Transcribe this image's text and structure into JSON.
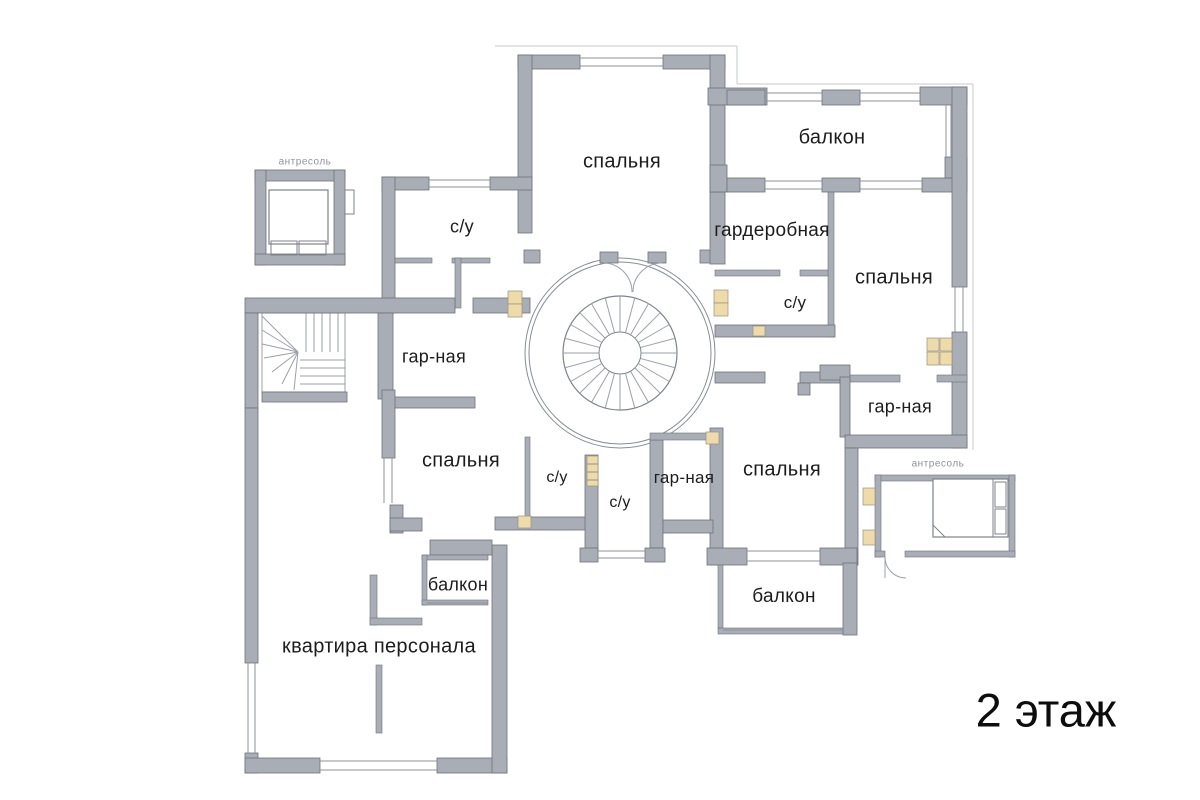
{
  "floor_title": {
    "text": "2 этаж",
    "x": 1046,
    "y": 710,
    "size": 47
  },
  "colors": {
    "background": "#ffffff",
    "wall_fill": "#a9adb5",
    "wall_outline": "#6d727c",
    "thin_line": "#8d929c",
    "shaft_fill": "#eedbaa",
    "label_text": "#1c1c1c",
    "mezzanine_label_text": "#8d939e",
    "title_text": "#0d0d0d"
  },
  "labels": [
    {
      "id": "bedroom-top",
      "text": "спальня",
      "x": 622,
      "y": 162,
      "size": 20
    },
    {
      "id": "balcony-top-right",
      "text": "балкон",
      "x": 832,
      "y": 138,
      "size": 20
    },
    {
      "id": "wardrobe-right",
      "text": "гардеробная",
      "x": 772,
      "y": 231,
      "size": 19
    },
    {
      "id": "bathroom-right",
      "text": "с/у",
      "x": 795,
      "y": 303,
      "size": 17
    },
    {
      "id": "bedroom-right",
      "text": "спальня",
      "x": 894,
      "y": 278,
      "size": 20
    },
    {
      "id": "dressing-right",
      "text": "гар-ная",
      "x": 900,
      "y": 407,
      "size": 18
    },
    {
      "id": "mezzanine-right",
      "text": "антресоль",
      "x": 938,
      "y": 464,
      "size": 10,
      "variant": "mezzanine"
    },
    {
      "id": "bathroom-left-top",
      "text": "с/у",
      "x": 462,
      "y": 227,
      "size": 18
    },
    {
      "id": "dressing-left",
      "text": "гар-ная",
      "x": 434,
      "y": 357,
      "size": 18
    },
    {
      "id": "bedroom-left",
      "text": "спальня",
      "x": 461,
      "y": 461,
      "size": 20
    },
    {
      "id": "bathroom-center-1",
      "text": "с/у",
      "x": 557,
      "y": 478,
      "size": 16
    },
    {
      "id": "bathroom-center-2",
      "text": "с/у",
      "x": 620,
      "y": 503,
      "size": 16
    },
    {
      "id": "dressing-center",
      "text": "гар-ная",
      "x": 684,
      "y": 478,
      "size": 17
    },
    {
      "id": "bedroom-bottom-right",
      "text": "спальня",
      "x": 782,
      "y": 470,
      "size": 20
    },
    {
      "id": "balcony-bottom-right",
      "text": "балкон",
      "x": 784,
      "y": 597,
      "size": 19
    },
    {
      "id": "balcony-bottom-left",
      "text": "балкон",
      "x": 458,
      "y": 585,
      "size": 18
    },
    {
      "id": "staff-apartment",
      "text": "квартира персонала",
      "x": 379,
      "y": 647,
      "size": 20
    },
    {
      "id": "mezzanine-left",
      "text": "антресоль",
      "x": 305,
      "y": 162,
      "size": 10,
      "variant": "mezzanine"
    }
  ]
}
